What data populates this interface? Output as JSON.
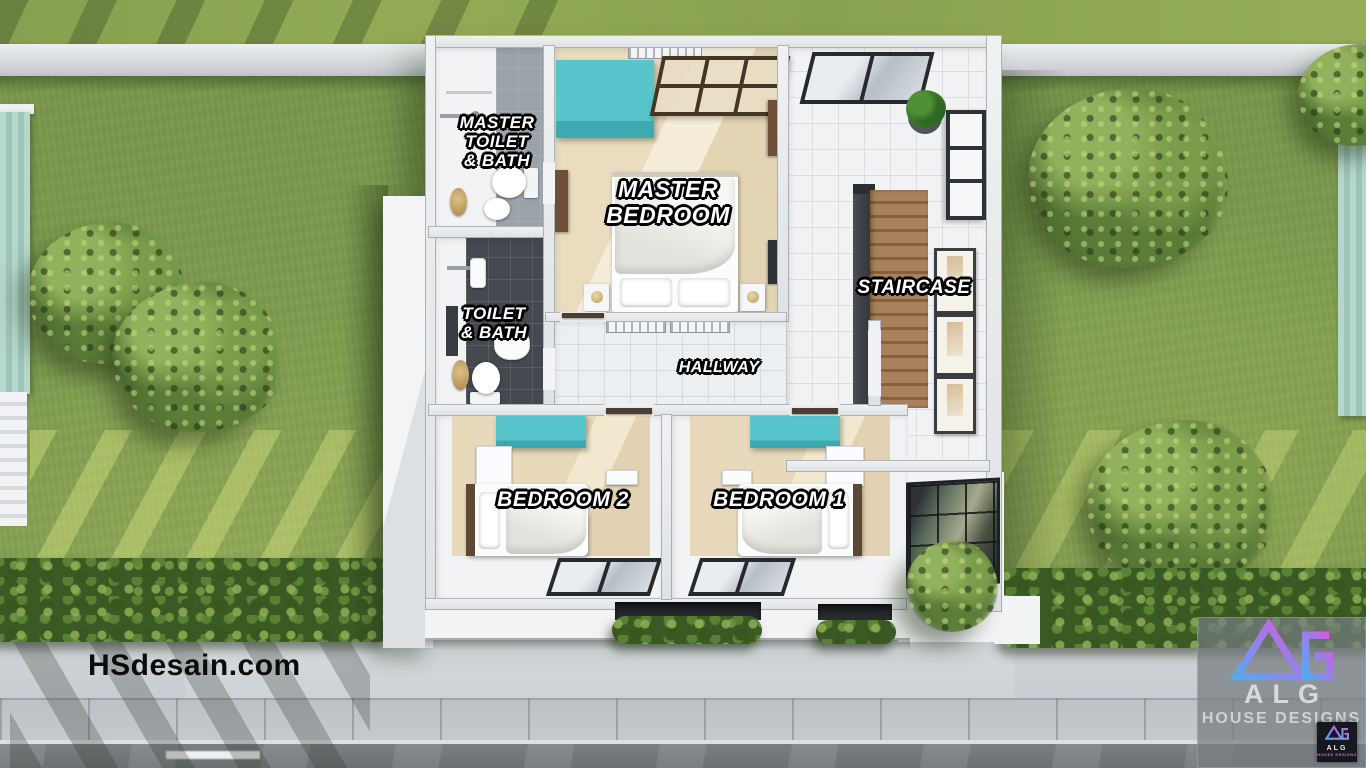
{
  "colors": {
    "lawn": "#7d9a4e",
    "teal-furniture": "#57c5cb",
    "wood-stairs": "#a9825c",
    "logo-gradient-start": "#55aaf0",
    "logo-gradient-end": "#d55ae4"
  },
  "floor_plan": {
    "rooms": {
      "master_toilet_bath": {
        "line1": "MASTER",
        "line2": "TOILET",
        "line3": "& BATH"
      },
      "toilet_bath": {
        "line1": "TOILET",
        "line2": "& BATH"
      },
      "master_bedroom": {
        "line1": "MASTER",
        "line2": "BEDROOM"
      },
      "hallway": {
        "label": "HALLWAY"
      },
      "staircase": {
        "label": "STAIRCASE"
      },
      "bedroom2": {
        "label": "BEDROOM 2"
      },
      "bedroom1": {
        "label": "BEDROOM 1"
      }
    }
  },
  "branding": {
    "watermark": "HSdesain.com",
    "studio_name": "ALG",
    "studio_tagline": "HOUSE DESIGNS",
    "badge_monogram": "ALG",
    "badge_caption": "HOUSE DESIGNS"
  }
}
